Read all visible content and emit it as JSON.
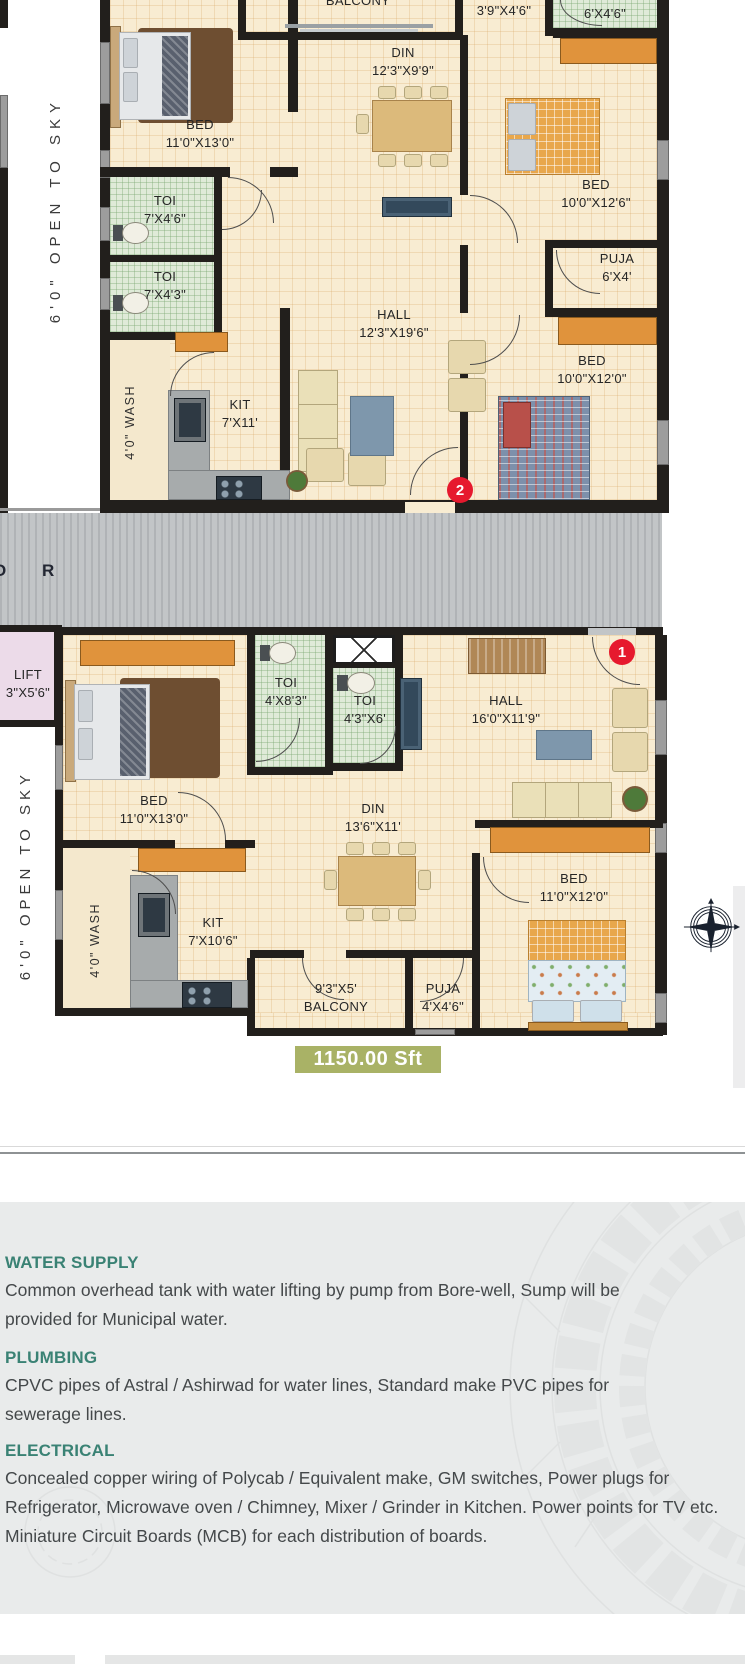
{
  "plan": {
    "open_to_sky_upper": "6'0\" OPEN TO SKY",
    "open_to_sky_lower": "6'0\" OPEN TO SKY",
    "corridor": {
      "letter_o": "O",
      "letter_r": "R"
    },
    "lift": {
      "name": "LIFT",
      "dim": "3\"X5'6\""
    },
    "area_badge": "1150.00 Sft",
    "unit2": {
      "marker": "2",
      "balcony": {
        "name": "BALCONY"
      },
      "dress": {
        "dim": "3'9\"X4'6\""
      },
      "toi_top": {
        "name": "TOI",
        "dim": "6'X4'6\""
      },
      "bed_left": {
        "name": "BED",
        "dim": "11'0\"X13'0\""
      },
      "toi_1": {
        "name": "TOI",
        "dim": "7'X4'6\""
      },
      "toi_2": {
        "name": "TOI",
        "dim": "7'X4'3\""
      },
      "din": {
        "name": "DIN",
        "dim": "12'3\"X9'9\""
      },
      "hall": {
        "name": "HALL",
        "dim": "12'3\"X19'6\""
      },
      "bed_top_right": {
        "name": "BED",
        "dim": "10'0\"X12'6\""
      },
      "puja": {
        "name": "PUJA",
        "dim": "6'X4'"
      },
      "bed_bottom_right": {
        "name": "BED",
        "dim": "10'0\"X12'0\""
      },
      "kit": {
        "name": "KIT",
        "dim": "7'X11'"
      },
      "wash": "4'0\" WASH"
    },
    "unit1": {
      "marker": "1",
      "bed_left": {
        "name": "BED",
        "dim": "11'0\"X13'0\""
      },
      "toi_1": {
        "name": "TOI",
        "dim": "4'X8'3\""
      },
      "toi_2": {
        "name": "TOI",
        "dim": "4'3\"X6'"
      },
      "hall": {
        "name": "HALL",
        "dim": "16'0\"X11'9\""
      },
      "din": {
        "name": "DIN",
        "dim": "13'6\"X11'"
      },
      "kit": {
        "name": "KIT",
        "dim": "7'X10'6\""
      },
      "wash": "4'0\" WASH",
      "balcony": {
        "dim": "9'3\"X5'",
        "name": "BALCONY"
      },
      "puja": {
        "name": "PUJA",
        "dim": "4'X4'6\""
      },
      "bed_right": {
        "name": "BED",
        "dim": "11'0\"X12'0\""
      }
    }
  },
  "specs": {
    "sections": [
      {
        "heading": "WATER SUPPLY",
        "body": "Common overhead tank with water lifting by pump from Bore-well, Sump will be provided for Municipal water."
      },
      {
        "heading": "PLUMBING",
        "body": "CPVC pipes of Astral / Ashirwad for water lines, Standard make PVC pipes for sewerage lines."
      },
      {
        "heading": "ELECTRICAL",
        "body": "Concealed copper wiring of Polycab / Equivalent make, GM switches, Power plugs for Refrigerator, Microwave oven / Chimney, Mixer / Grinder in Kitchen. Power points for TV etc. Miniature Circuit Boards (MCB) for each distribution of boards."
      }
    ]
  },
  "colors": {
    "heading_teal": "#3A8274",
    "area_badge_bg": "#A9B266",
    "marker_red": "#E6192E"
  }
}
